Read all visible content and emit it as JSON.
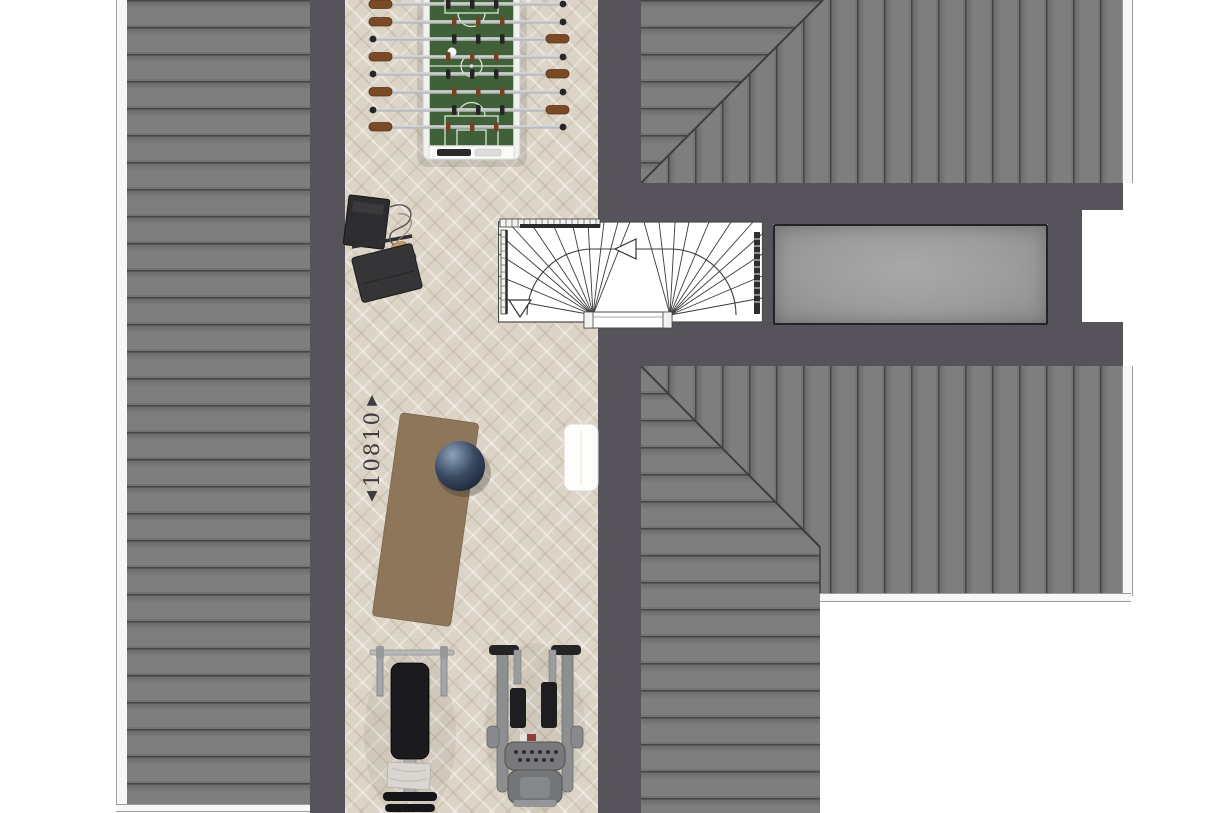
{
  "document": {
    "kind": "architectural floor plan, top-down attic level"
  },
  "dimension_marker": {
    "value": "10810",
    "arrow_up": "▲",
    "arrow_down": "▼"
  },
  "colors": {
    "page_background": "#FFFFFF",
    "wall_dark": "#56545A",
    "roof_plank": "#7B7B7B",
    "roof_seam": "#454545",
    "floor_base": "#DCD4C6",
    "skylight_fill": "#9C9C9C",
    "field_green": "#40603A",
    "handle_brown": "#7A4A26",
    "mat_brown": "#8E765B",
    "ball_navy": "#2C3850",
    "equipment_black": "#1B1B1D",
    "machine_gray": "#8C8E90",
    "stair_line": "#3A3A3A"
  },
  "plan_items": [
    "left-roof-slope",
    "upper-right-roof-slope",
    "lower-right-roof-slope",
    "corridor-floor",
    "staircase",
    "stair-landing",
    "skylight",
    "foosball-table",
    "av-equipment",
    "exercise-mat",
    "exercise-ball",
    "radiator",
    "dimension-marker",
    "weight-bench",
    "elliptical-trainer"
  ]
}
